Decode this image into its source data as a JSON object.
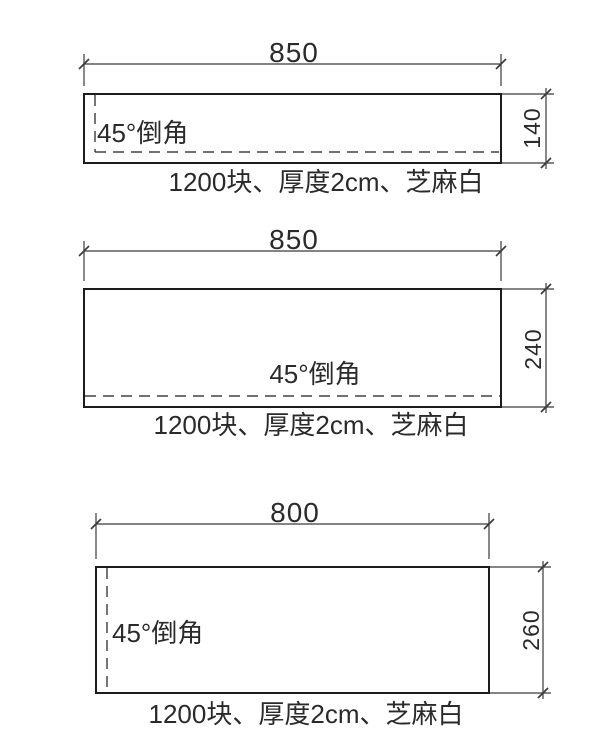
{
  "panels": [
    {
      "width_dim": "850",
      "height_dim": "140",
      "chamfer_label": "45°倒角",
      "caption": "1200块、厚度2cm、芝麻白",
      "chamfer_edges": "left-and-bottom"
    },
    {
      "width_dim": "850",
      "height_dim": "240",
      "chamfer_label": "45°倒角",
      "caption": "1200块、厚度2cm、芝麻白",
      "chamfer_edges": "bottom"
    },
    {
      "width_dim": "800",
      "height_dim": "260",
      "chamfer_label": "45°倒角",
      "caption": "1200块、厚度2cm、芝麻白",
      "chamfer_edges": "left"
    }
  ],
  "colors": {
    "background": "#ffffff",
    "object_line": "#1c1c1c",
    "dimension_line": "#3a3a3a",
    "text": "#2a2a2a"
  }
}
